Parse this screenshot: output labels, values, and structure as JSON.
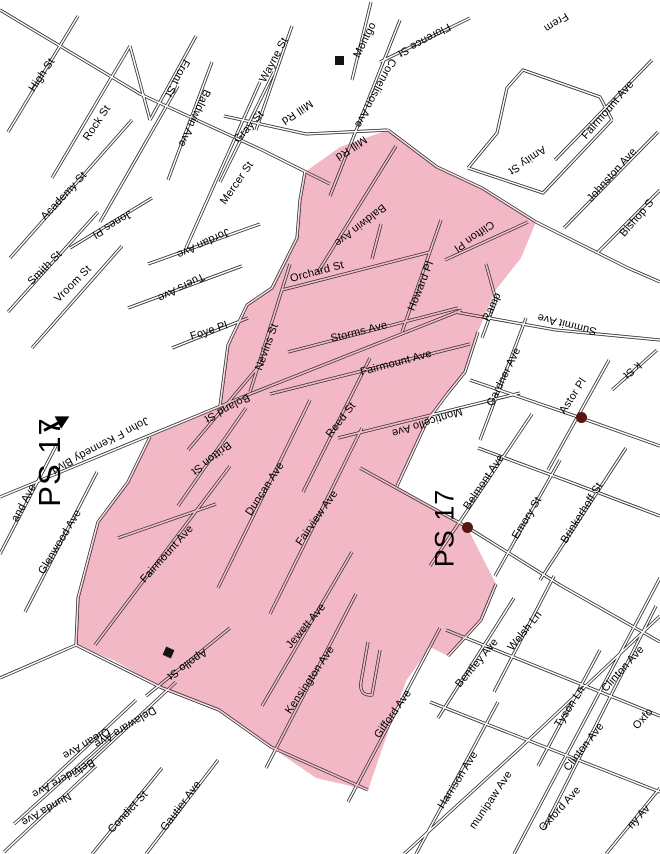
{
  "map": {
    "zone": {
      "name": "PS 17",
      "fill_color": "#f2b8c6",
      "road_color": "#1d1d1d",
      "marker_color": "#5a1414"
    },
    "school_labels": [
      {
        "text": "PS 17",
        "x": 50,
        "y": 462,
        "r": -90,
        "size": 31
      },
      {
        "text": "PS 17",
        "x": 445,
        "y": 528,
        "r": -90,
        "size": 27
      }
    ],
    "street_labels": [
      {
        "text": "High St",
        "x": 42,
        "y": 75,
        "r": -56
      },
      {
        "text": "Rock St",
        "x": 97,
        "y": 123,
        "r": -56
      },
      {
        "text": "Front St",
        "x": 177,
        "y": 78,
        "r": 118
      },
      {
        "text": "Baldwin Ave",
        "x": 194,
        "y": 118,
        "r": 115
      },
      {
        "text": "Academy St",
        "x": 64,
        "y": 196,
        "r": -47
      },
      {
        "text": "Smith St",
        "x": 45,
        "y": 268,
        "r": -45
      },
      {
        "text": "Vroom St",
        "x": 73,
        "y": 284,
        "r": -45
      },
      {
        "text": "Jones Pl",
        "x": 112,
        "y": 224,
        "r": 149
      },
      {
        "text": "Jordan Ave",
        "x": 203,
        "y": 243,
        "r": 155
      },
      {
        "text": "Tuers Ave",
        "x": 181,
        "y": 287,
        "r": 153
      },
      {
        "text": "Mercer St",
        "x": 237,
        "y": 183,
        "r": -55
      },
      {
        "text": "Gray St",
        "x": 249,
        "y": 127,
        "r": -48
      },
      {
        "text": "Wayne St",
        "x": 274,
        "y": 60,
        "r": -62
      },
      {
        "text": "Mill Rd",
        "x": 297,
        "y": 112,
        "r": 146
      },
      {
        "text": "Mill Rd",
        "x": 351,
        "y": 148,
        "r": 146
      },
      {
        "text": "Cornelison Ave",
        "x": 375,
        "y": 93,
        "r": 118
      },
      {
        "text": "Montgo",
        "x": 365,
        "y": 40,
        "r": -64
      },
      {
        "text": "Florence St",
        "x": 424,
        "y": 40,
        "r": 151
      },
      {
        "text": "Frem",
        "x": 556,
        "y": 22,
        "r": 148
      },
      {
        "text": "Amity St",
        "x": 527,
        "y": 160,
        "r": 146
      },
      {
        "text": "Fairmount Ave",
        "x": 608,
        "y": 110,
        "r": -49
      },
      {
        "text": "Johnston Ave",
        "x": 612,
        "y": 175,
        "r": -48
      },
      {
        "text": "Bishop S",
        "x": 637,
        "y": 218,
        "r": -49
      },
      {
        "text": "Clifton Pl",
        "x": 474,
        "y": 236,
        "r": 145
      },
      {
        "text": "Orchard St",
        "x": 317,
        "y": 272,
        "r": -15
      },
      {
        "text": "Baldwin Ave",
        "x": 360,
        "y": 225,
        "r": 142
      },
      {
        "text": "Howard Pl",
        "x": 421,
        "y": 286,
        "r": -68
      },
      {
        "text": "Storms Ave",
        "x": 359,
        "y": 332,
        "r": -14
      },
      {
        "text": "Fairmount Ave",
        "x": 396,
        "y": 363,
        "r": -15
      },
      {
        "text": "Foye Pl",
        "x": 209,
        "y": 331,
        "r": -18
      },
      {
        "text": "Nevins St",
        "x": 267,
        "y": 347,
        "r": -70
      },
      {
        "text": "Ramp",
        "x": 492,
        "y": 307,
        "r": -66
      },
      {
        "text": "Summit Ave",
        "x": 567,
        "y": 324,
        "r": -166
      },
      {
        "text": "Gardner Ave",
        "x": 504,
        "y": 377,
        "r": -64
      },
      {
        "text": "Monticello Ave",
        "x": 427,
        "y": 422,
        "r": 162
      },
      {
        "text": "Belmont Ave",
        "x": 484,
        "y": 482,
        "r": -56
      },
      {
        "text": "Reed St",
        "x": 341,
        "y": 420,
        "r": -52
      },
      {
        "text": "Boland St",
        "x": 227,
        "y": 408,
        "r": 152
      },
      {
        "text": "Britton St",
        "x": 211,
        "y": 458,
        "r": 142
      },
      {
        "text": "Duncan Ave",
        "x": 265,
        "y": 489,
        "r": -57
      },
      {
        "text": "Fairview Ave",
        "x": 317,
        "y": 518,
        "r": -55
      },
      {
        "text": "Fairmount Ave",
        "x": 167,
        "y": 554,
        "r": -48
      },
      {
        "text": "Glenwood Ave",
        "x": 60,
        "y": 542,
        "r": -59
      },
      {
        "text": "and Ave",
        "x": 24,
        "y": 503,
        "r": -62
      },
      {
        "text": "John F Kennedy Blvd",
        "x": 100,
        "y": 445,
        "r": 152
      },
      {
        "text": "Emory St",
        "x": 527,
        "y": 518,
        "r": -59
      },
      {
        "text": "Brinkerhoff St",
        "x": 582,
        "y": 513,
        "r": -58
      },
      {
        "text": "Astor Pl",
        "x": 573,
        "y": 396,
        "r": -57
      },
      {
        "text": "k St",
        "x": 632,
        "y": 370,
        "r": 140
      },
      {
        "text": "Jewett Ave",
        "x": 306,
        "y": 626,
        "r": -50
      },
      {
        "text": "Kensington Ave",
        "x": 310,
        "y": 680,
        "r": -56
      },
      {
        "text": "Gifford Ave",
        "x": 393,
        "y": 714,
        "r": -55
      },
      {
        "text": "Apollo St",
        "x": 187,
        "y": 664,
        "r": 145
      },
      {
        "text": "Delaware Ave",
        "x": 125,
        "y": 727,
        "r": 149
      },
      {
        "text": "Olean Ave",
        "x": 86,
        "y": 743,
        "r": 150
      },
      {
        "text": "Belvidere Ave",
        "x": 63,
        "y": 778,
        "r": 151
      },
      {
        "text": "Nunda Ave",
        "x": 46,
        "y": 809,
        "r": 150
      },
      {
        "text": "Condict St",
        "x": 128,
        "y": 812,
        "r": -47
      },
      {
        "text": "Gautier Ave",
        "x": 181,
        "y": 806,
        "r": -53
      },
      {
        "text": "Harrison Ave",
        "x": 458,
        "y": 780,
        "r": -58
      },
      {
        "text": "Bentley Ave",
        "x": 477,
        "y": 663,
        "r": -50
      },
      {
        "text": "Welsh Ln",
        "x": 525,
        "y": 631,
        "r": -51
      },
      {
        "text": "Tyson Ln",
        "x": 570,
        "y": 707,
        "r": -57
      },
      {
        "text": "Clinton Ave",
        "x": 623,
        "y": 669,
        "r": -48
      },
      {
        "text": "Clinton Ave",
        "x": 584,
        "y": 747,
        "r": -52
      },
      {
        "text": "Oxford Ave",
        "x": 560,
        "y": 809,
        "r": -48
      },
      {
        "text": "Oxfo",
        "x": 643,
        "y": 719,
        "r": -48
      },
      {
        "text": "munipaw Ave",
        "x": 491,
        "y": 800,
        "r": -56
      },
      {
        "text": "ny Av",
        "x": 639,
        "y": 817,
        "r": -48
      }
    ],
    "markers": [
      {
        "type": "dot",
        "name": "school-location-dot",
        "x": 467,
        "y": 527
      },
      {
        "type": "dot",
        "name": "school-location-dot",
        "x": 581,
        "y": 417
      },
      {
        "type": "square",
        "name": "building-marker",
        "x": 168,
        "y": 652,
        "r": 24
      },
      {
        "type": "square",
        "name": "building-marker",
        "x": 339,
        "y": 60,
        "r": 0
      },
      {
        "type": "arrow",
        "name": "zone-pointer-arrow",
        "x": 57,
        "y": 423,
        "r": -28
      }
    ]
  }
}
